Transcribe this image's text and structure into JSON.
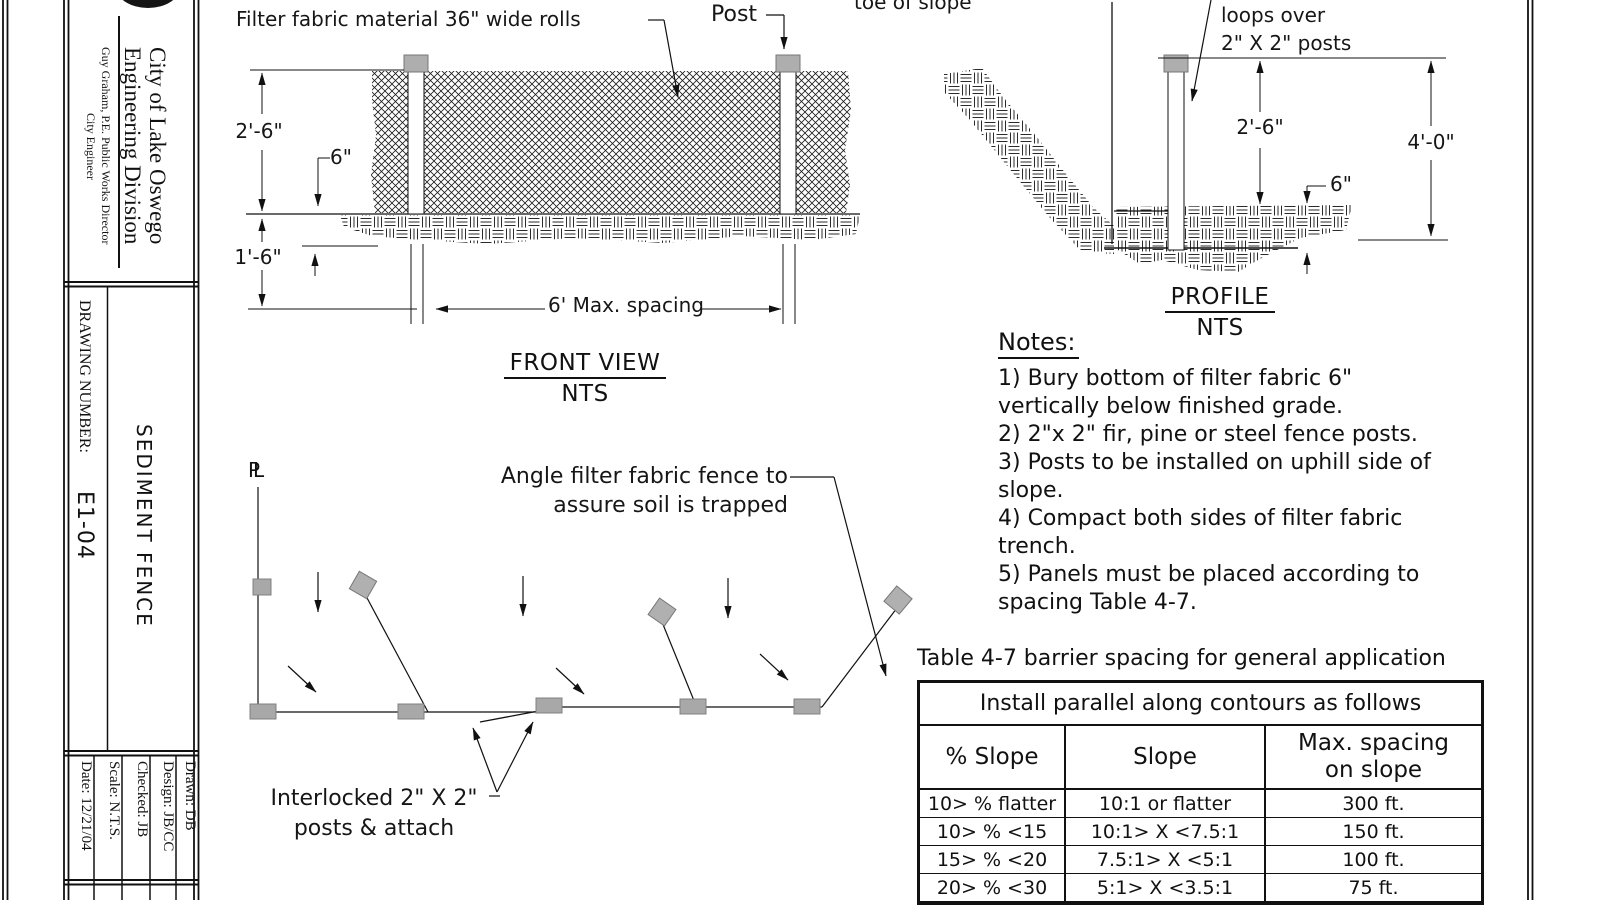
{
  "title_block": {
    "agency": [
      "City of Lake Oswego",
      "Engineering Division"
    ],
    "official": "Guy Graham, P.E. Public Works Director",
    "official_title": "City Engineer",
    "drawing_number_label": "DRAWING NUMBER:",
    "drawing_number": "E1-04",
    "sheet_title": "SEDIMENT FENCE",
    "fields": [
      "Date: 12/21/04",
      "Scale: N.T.S.",
      "Checked: JB",
      "Design: JB/CC",
      "Drawn: DB"
    ]
  },
  "front_view": {
    "title": "FRONT VIEW",
    "scale_note": "NTS",
    "callouts": {
      "fabric": "Filter fabric material 36\" wide rolls",
      "post": "Post"
    },
    "dimensions": {
      "fence_height": "2'-6\"",
      "fabric_lap": "6\"",
      "bury_depth": "1'-6\"",
      "post_spacing": "6' Max. spacing"
    }
  },
  "profile_view": {
    "title": "PROFILE",
    "scale_note": "NTS",
    "callouts": {
      "toe": "toe of slope",
      "loops_line1": "loops over",
      "loops_line2": "2\" X 2\" posts"
    },
    "dimensions": {
      "fabric_height": "2'-6\"",
      "post_height": "4'-0\"",
      "bury_depth": "6\""
    }
  },
  "plan_view": {
    "pl_symbol": "PL",
    "callouts": {
      "angle_line1": "Angle filter fabric fence to",
      "angle_line2": "assure soil is trapped",
      "interlock_line1": "Interlocked 2\" X 2\"",
      "interlock_line2": "posts & attach"
    }
  },
  "notes": {
    "heading": "Notes:",
    "lines": [
      "1) Bury bottom of filter fabric 6\"",
      "vertically below finished grade.",
      "2) 2\"x 2\" fir, pine or steel fence posts.",
      "3) Posts to be installed on uphill side of",
      "slope.",
      "4) Compact both sides of filter fabric",
      "trench.",
      "5) Panels must be placed according to",
      "spacing Table 4-7."
    ]
  },
  "spacing_table": {
    "title": "Table 4-7 barrier spacing for general application",
    "subheader": "Install parallel along contours as follows",
    "columns": [
      "% Slope",
      "Slope",
      "Max. spacing on slope"
    ],
    "rows": [
      [
        "10> % flatter",
        "10:1 or flatter",
        "300 ft."
      ],
      [
        "10> % <15",
        "10:1> X <7.5:1",
        "150 ft."
      ],
      [
        "15> % <20",
        "7.5:1> X <5:1",
        "100 ft."
      ],
      [
        "20> % <30",
        "5:1> X <3.5:1",
        "75 ft."
      ]
    ]
  },
  "colors": {
    "ink": "#161616",
    "post_gray": "#a8a8a8",
    "paper": "#ffffff"
  }
}
